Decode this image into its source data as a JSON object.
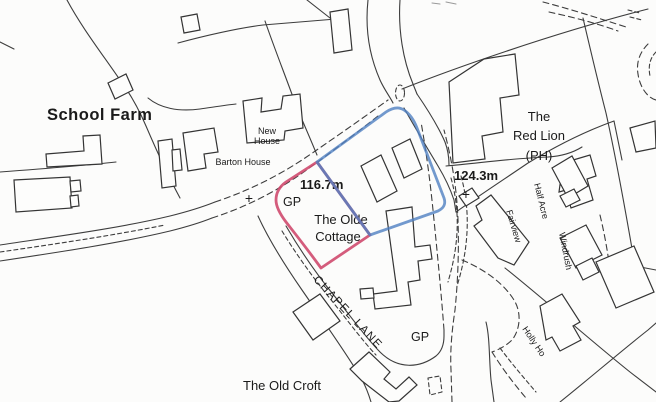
{
  "map": {
    "type": "site-location-plan",
    "colors": {
      "background": "#fcfcfb",
      "line": "#3d3d3d",
      "text": "#1a1a1a",
      "red_boundary": "#cf4a6e",
      "blue_boundary": "#4f80c2"
    },
    "labels": {
      "school_farm": "School Farm",
      "new_house_line1": "New",
      "new_house_line2": "House",
      "barton_house": "Barton House",
      "spot_height_west": "116.7m",
      "guide_post_west": "GP",
      "olde_cottage_line1": "The Olde",
      "olde_cottage_line2": "Cottage",
      "spot_height_east": "124.3m",
      "red_lion_line1": "The",
      "red_lion_line2": "Red Lion",
      "red_lion_line3": "(PH)",
      "chapel_lane": "CHAPEL LANE",
      "guide_post_south": "GP",
      "old_croft": "The Old Croft",
      "fairview": "Fairview",
      "half_acre": "Half Acre",
      "windrush": "Windrush",
      "holly_ho": "Holly Ho",
      "survey_cross": "+"
    }
  }
}
